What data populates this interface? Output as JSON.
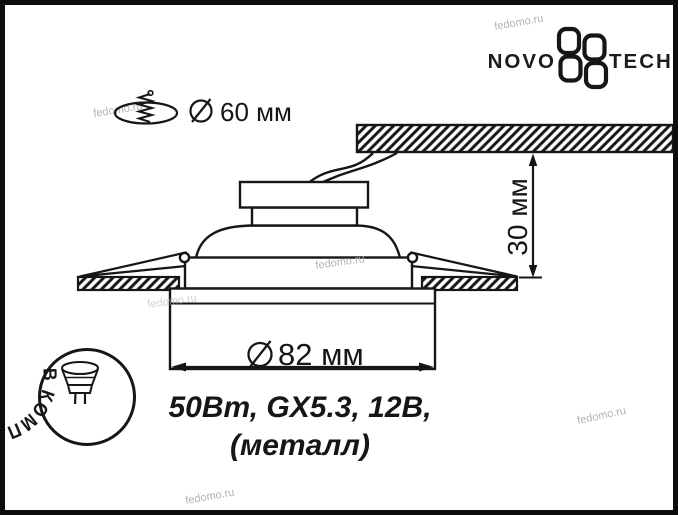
{
  "brand": {
    "name_left": "NOVO",
    "name_right": "TECH"
  },
  "watermark": {
    "text": "fedomo.ru"
  },
  "dimensions": {
    "cutout_diameter": "60 мм",
    "recess_depth": "30 мм",
    "outer_diameter": "82 мм"
  },
  "specs": {
    "line1": "50Вт, GX5.3, 12В,",
    "line2": "(металл)"
  },
  "stamp": {
    "text": "В КОМПЛЕКТ НЕ ВХОДИТ"
  },
  "colors": {
    "ink": "#161616",
    "watermark": "#b3b3b3",
    "background": "#ffffff"
  }
}
